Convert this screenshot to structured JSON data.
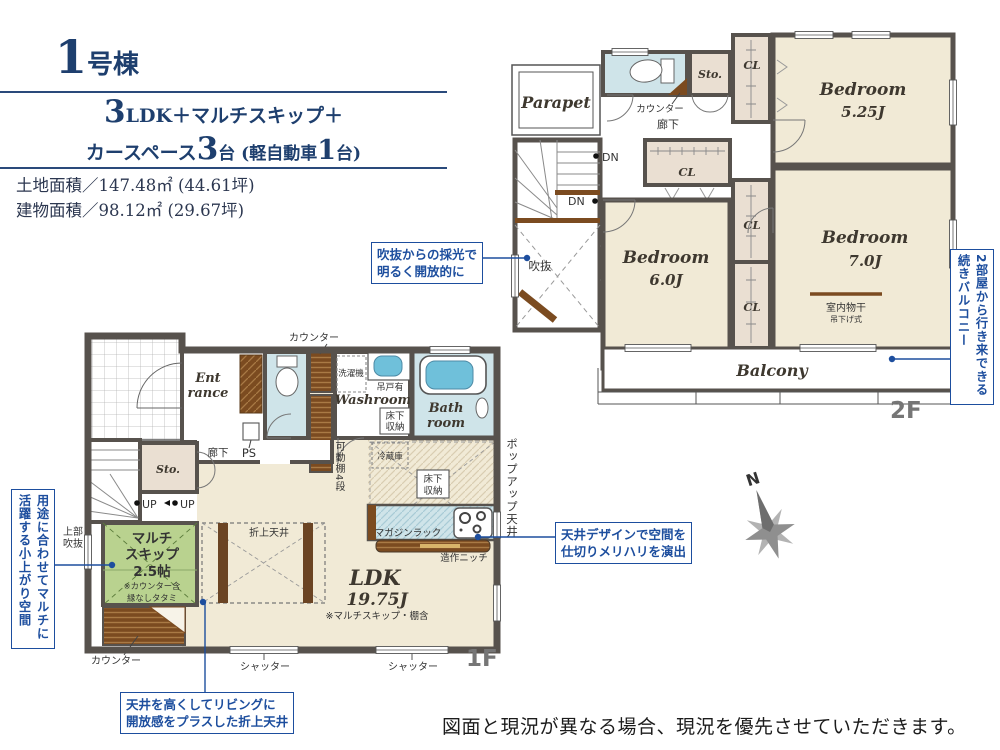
{
  "colors": {
    "navy": "#1e3f6e",
    "annotation_blue": "#1d4e9e",
    "wall_gray": "#57524d",
    "room_cream": "#f1ead6",
    "room_blue": "#cfe4e9",
    "room_green": "#b9d28f",
    "closet_beige": "#eadfd2",
    "wood_brown": "#7b4b20",
    "floor_label_gray": "#767676"
  },
  "header": {
    "building_num": "1",
    "building_suffix": "号棟",
    "plan_num1": "3",
    "plan_text1": "LDK＋マルチスキップ＋",
    "plan_text2": "カースペース",
    "plan_num2": "3",
    "plan_text3": "台 (軽自動車",
    "plan_num3": "1",
    "plan_text4": "台)",
    "land_area": "土地面積／147.48㎡ (44.61坪)",
    "building_area": "建物面積／98.12㎡ (29.67坪)"
  },
  "floor2": {
    "label": "2F",
    "parapet": "Parapet",
    "counter": "カウンター",
    "hall": "廊下",
    "sto": "Sto.",
    "cl": "CL",
    "dn": "DN",
    "void": "吹抜",
    "bedroom_a_name": "Bedroom",
    "bedroom_a_size": "5.25J",
    "bedroom_b_name": "Bedroom",
    "bedroom_b_size": "6.0J",
    "bedroom_c_name": "Bedroom",
    "bedroom_c_size": "7.0J",
    "drying": "室内物干",
    "drying_sub": "吊下げ式",
    "balcony": "Balcony"
  },
  "floor1": {
    "label": "1F",
    "counter_top": "カウンター",
    "entrance_l1": "Ent",
    "entrance_l2": "rance",
    "washer": "洗濯機",
    "hanging": "吊戸有",
    "washroom": "Washroom",
    "underfloor_l1": "床下",
    "underfloor_l2": "収納",
    "bath_l1": "Bath",
    "bath_l2": "room",
    "sto": "Sto.",
    "hall": "廊下",
    "ps": "PS",
    "shelf": "可動棚4段",
    "fridge": "冷蔵庫",
    "popup_ceiling": "ポップアップ天井",
    "up": "UP",
    "upper_void_l1": "上部",
    "upper_void_l2": "吹抜",
    "multi_l1": "マルチ",
    "multi_l2": "スキップ",
    "multi_l3": "2.5帖",
    "multi_note1": "※カウンター含",
    "multi_note2": "縁なしタタミ",
    "counter_bottom": "カウンター",
    "coffered": "折上天井",
    "ldk": "LDK",
    "ldk_size": "19.75J",
    "ldk_note": "※マルチスキップ・棚含",
    "magazine_rack": "マガジンラック",
    "niche": "造作ニッチ",
    "shutter": "シャッター"
  },
  "annotations": {
    "void_light_l1": "吹抜からの採光で",
    "void_light_l2": "明るく開放的に",
    "balcony_note": "2部屋から行き来できる続きバルコニー",
    "multi_space_note": "用途に合わせてマルチに活躍する小上がり空間",
    "ceiling_design_l1": "天井デザインで空間を",
    "ceiling_design_l2": "仕切りメリハリを演出",
    "coffered_l1": "天井を高くしてリビングに",
    "coffered_l2": "開放感をプラスした折上天井"
  },
  "compass": {
    "north": "N"
  },
  "disclaimer": "図面と現況が異なる場合、現況を優先させていただきます。"
}
